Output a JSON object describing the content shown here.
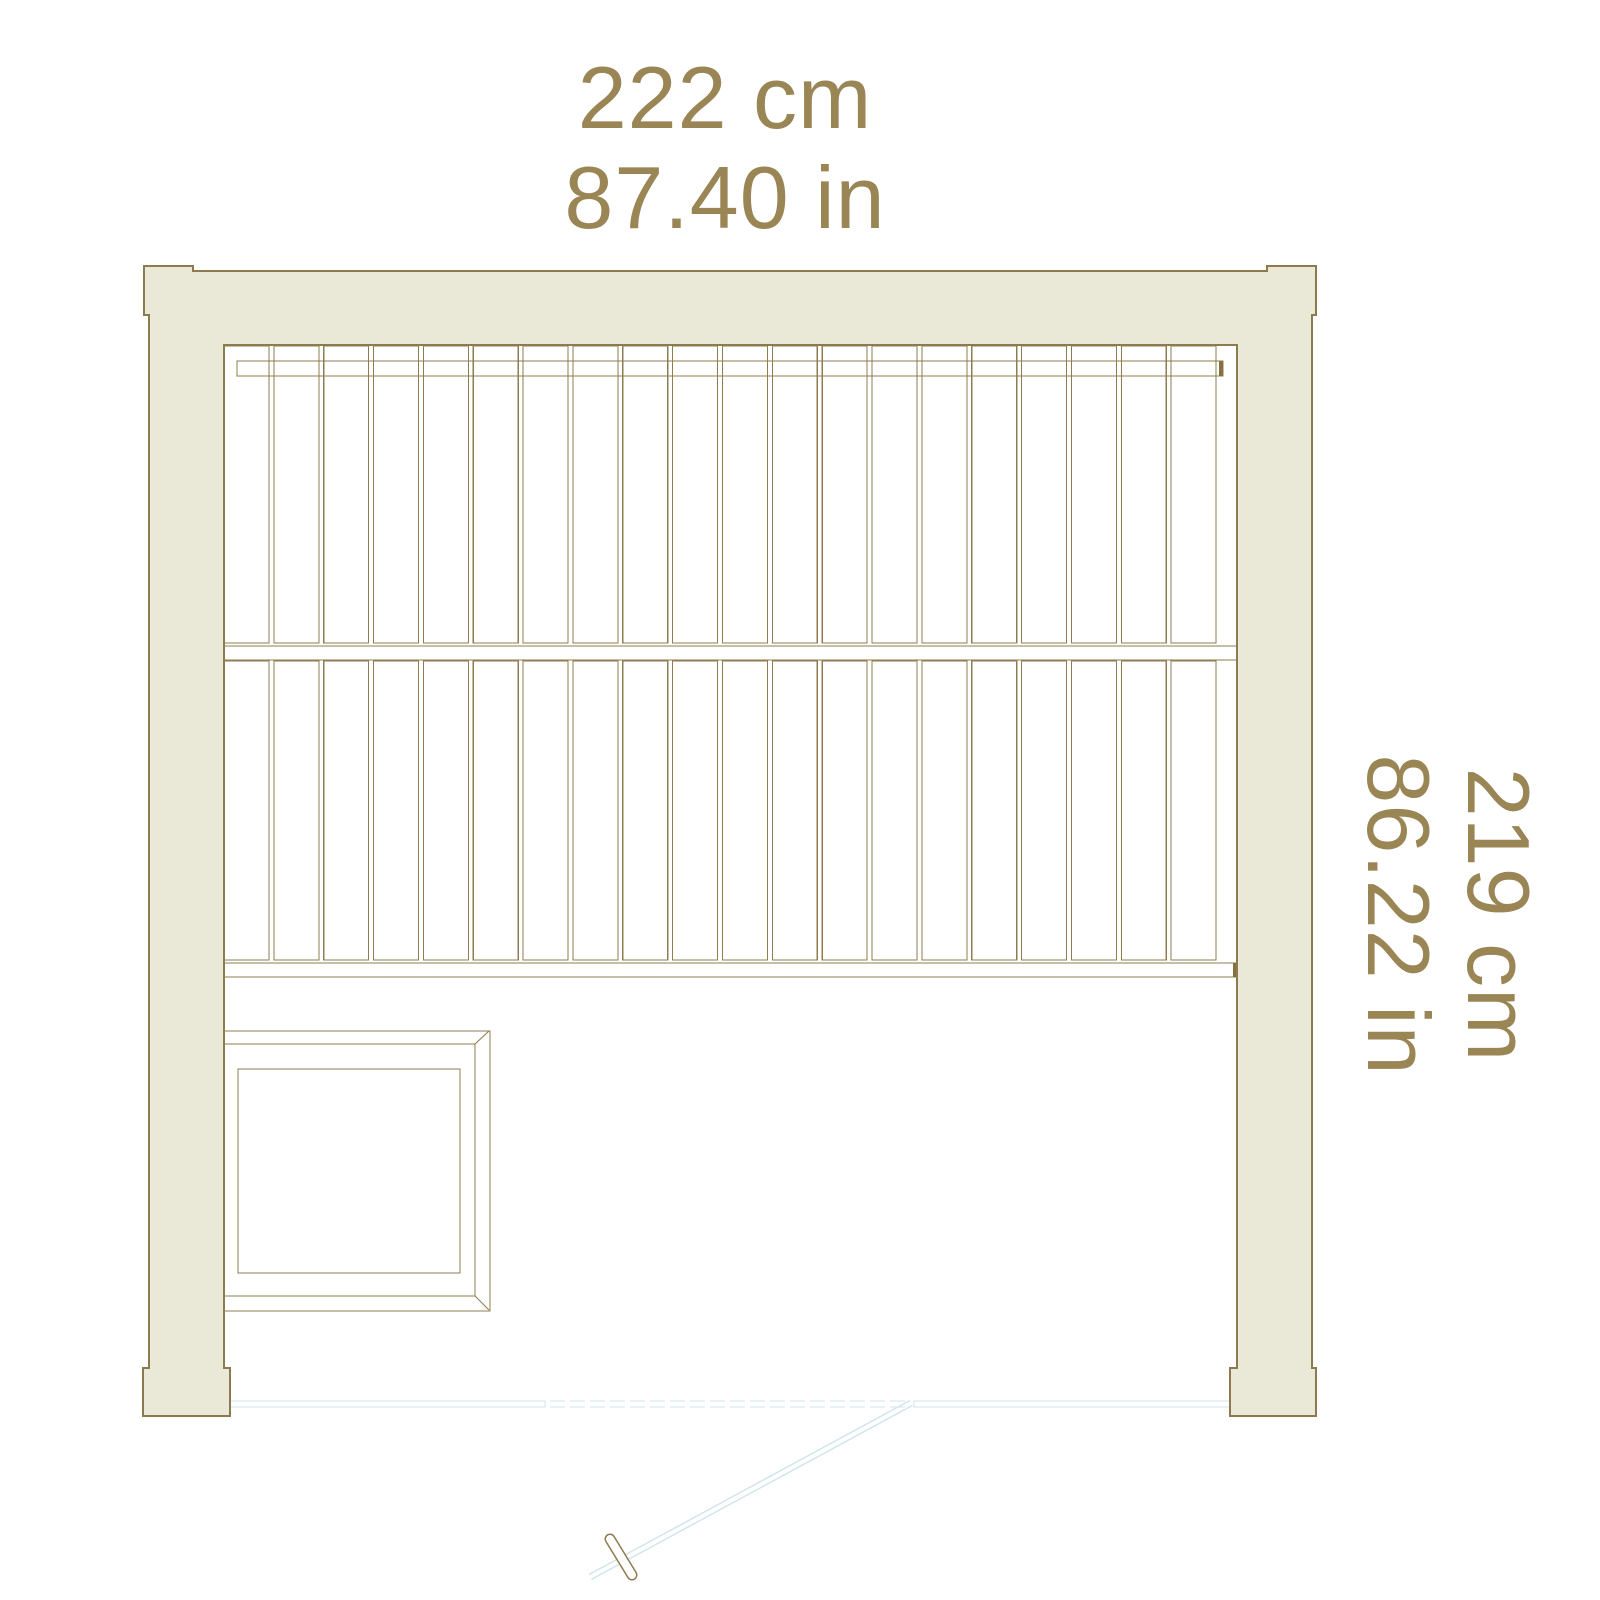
{
  "drawing": {
    "type": "sauna floor plan",
    "width_label": {
      "cm": "222 cm",
      "inches": "87.40 in"
    },
    "depth_label": {
      "cm": "219 cm",
      "inches": "86.22 in"
    }
  },
  "bench": {
    "rows": 2,
    "slat_count_per_row": 20
  },
  "colors": {
    "frame_fill": "#eae8d6",
    "frame_outline": "#8d7a4e",
    "dimension_text": "#9a8555",
    "door_line": "#cfe4eb",
    "background": "#ffffff"
  }
}
